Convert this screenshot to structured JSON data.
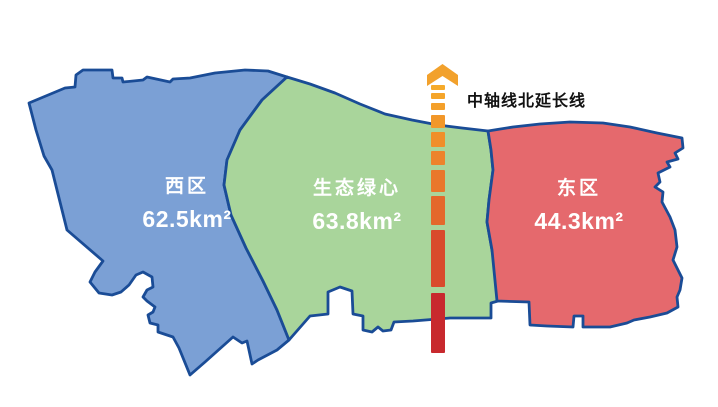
{
  "map": {
    "regions": [
      {
        "id": "west",
        "name": "西区",
        "area": "62.5km²",
        "fill": "#7BA0D5"
      },
      {
        "id": "green-heart",
        "name": "生态绿心",
        "area": "63.8km²",
        "fill": "#A9D59B"
      },
      {
        "id": "east",
        "name": "东区",
        "area": "44.3km²",
        "fill": "#E5696D"
      }
    ],
    "border_color": "#1A4C96",
    "label_text_color": "#FFFFFF"
  },
  "axis": {
    "label": "中轴线北延长线",
    "label_color": "#111111",
    "arrow_icon": "chevron-up-arrow",
    "arrow_color": "#F2A12C",
    "x": 431,
    "width": 14,
    "dashes": [
      {
        "y": 85,
        "h": 5,
        "color": "#F6AA2A"
      },
      {
        "y": 93,
        "h": 6,
        "color": "#F5A52A"
      },
      {
        "y": 103,
        "h": 7,
        "color": "#F4A02A"
      },
      {
        "y": 115,
        "h": 13,
        "color": "#F29729"
      },
      {
        "y": 132,
        "h": 15,
        "color": "#F08E2A"
      },
      {
        "y": 151,
        "h": 14,
        "color": "#ED832B"
      },
      {
        "y": 170,
        "h": 22,
        "color": "#E9772B"
      },
      {
        "y": 196,
        "h": 29,
        "color": "#E4682B"
      },
      {
        "y": 230,
        "h": 57,
        "color": "#D94A2C"
      },
      {
        "y": 293,
        "h": 60,
        "color": "#C8292E"
      }
    ]
  }
}
